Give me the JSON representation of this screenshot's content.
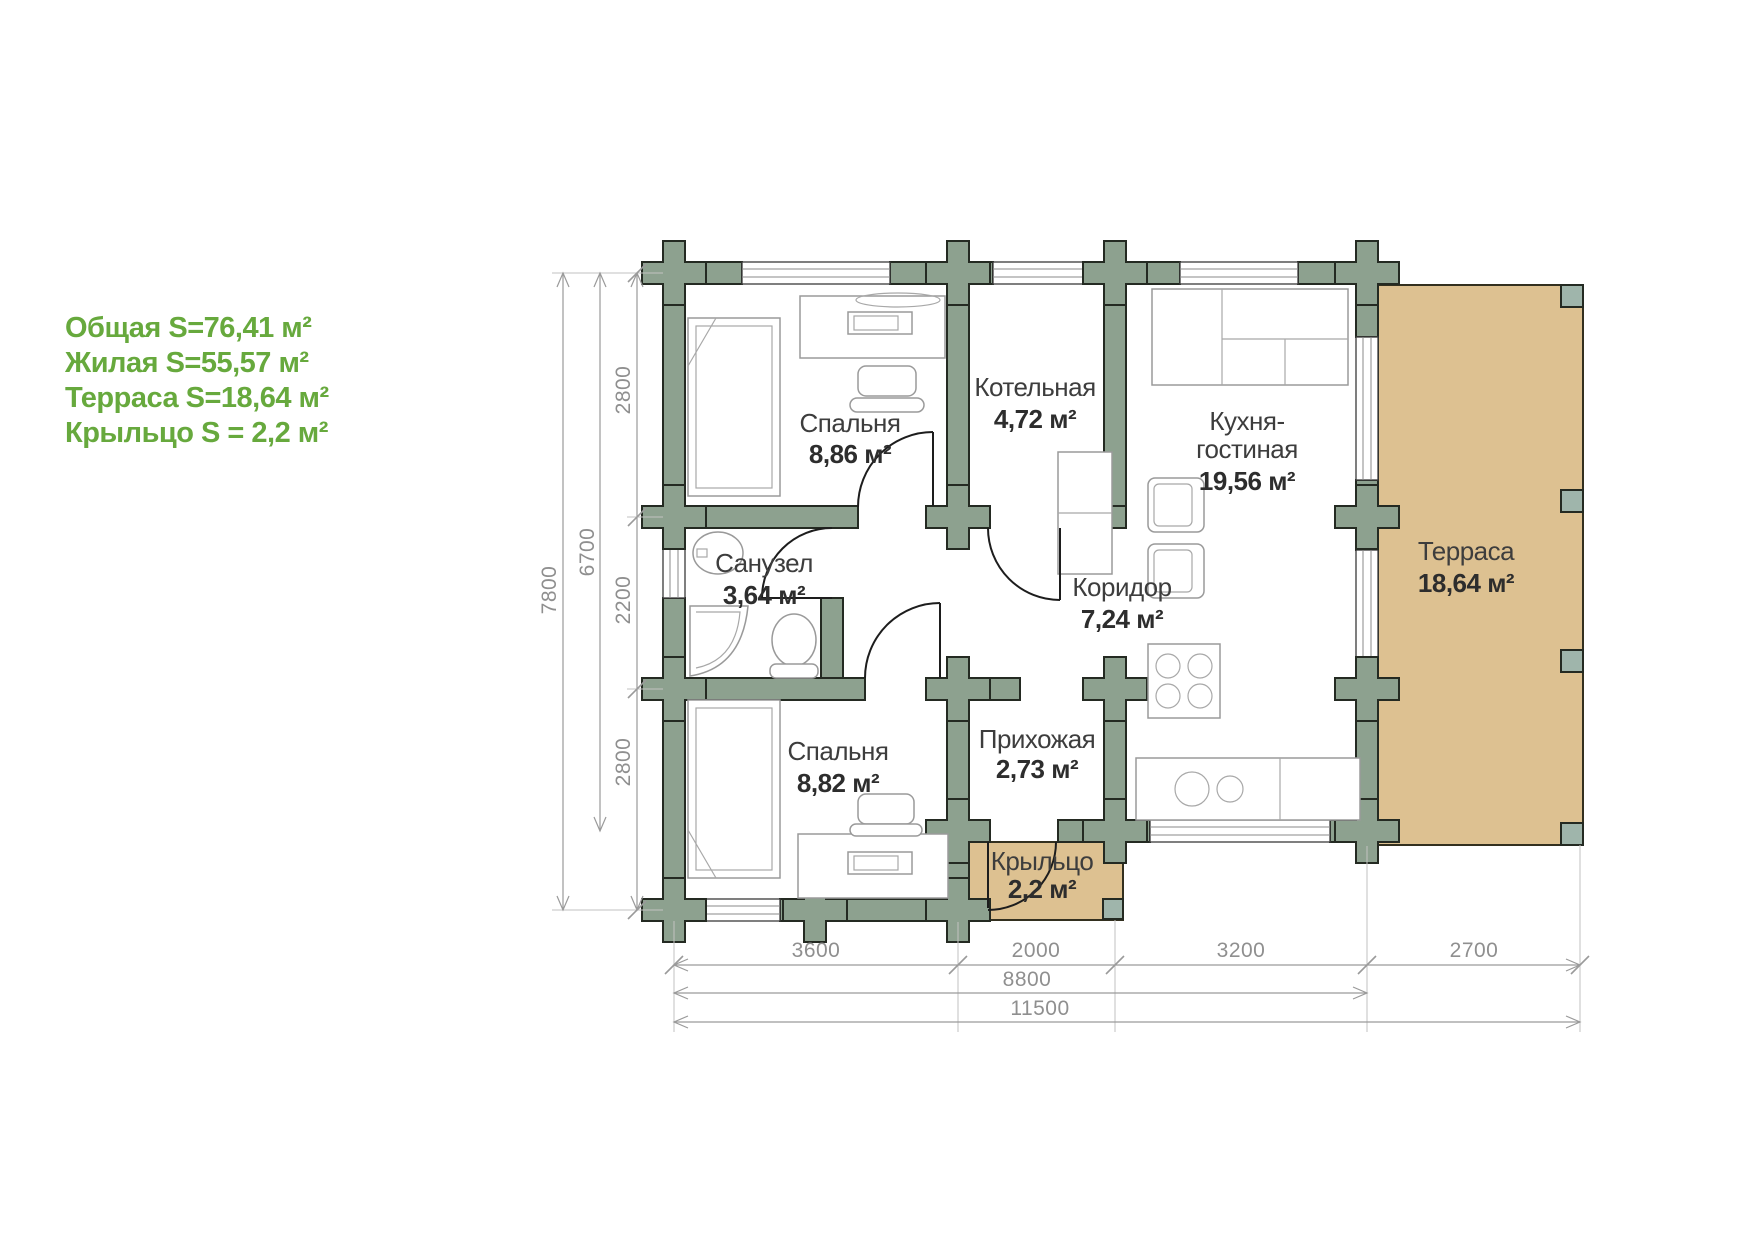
{
  "legend": {
    "color": "#67a93d",
    "lines": [
      "Общая S=76,41 м²",
      "Жилая S=55,57 м²",
      "Терраса S=18,64 м²",
      "Крыльцо S = 2,2 м²"
    ]
  },
  "rooms": [
    {
      "id": "bedroom-1",
      "name": "Спальня",
      "area": "8,86 м²"
    },
    {
      "id": "boiler-room",
      "name": "Котельная",
      "area": "4,72 м²"
    },
    {
      "id": "kitchen-living",
      "name_line1": "Кухня-",
      "name_line2": "гостиная",
      "area": "19,56 м²"
    },
    {
      "id": "bathroom",
      "name": "Санузел",
      "area": "3,64 м²"
    },
    {
      "id": "corridor",
      "name": "Коридор",
      "area": "7,24 м²"
    },
    {
      "id": "hallway",
      "name": "Прихожая",
      "area": "2,73 м²"
    },
    {
      "id": "bedroom-2",
      "name": "Спальня",
      "area": "8,82 м²"
    },
    {
      "id": "porch",
      "name": "Крыльцо",
      "area": "2,2 м²"
    },
    {
      "id": "terrace",
      "name": "Терраса",
      "area": "18,64 м²"
    }
  ],
  "dimensions": {
    "vertical_total": "7800",
    "vertical_main": "6700",
    "vertical_segments": [
      "2800",
      "2200",
      "2800"
    ],
    "horizontal_segments": [
      "3600",
      "2000",
      "3200",
      "2700"
    ],
    "horizontal_main": "8800",
    "horizontal_total": "11500"
  },
  "colors": {
    "wall": "#8da18f",
    "terrace": "#ddc191",
    "legend_green": "#67a93d",
    "label_text": "#3d3d3d",
    "dimension_text": "#8f8f8f"
  }
}
